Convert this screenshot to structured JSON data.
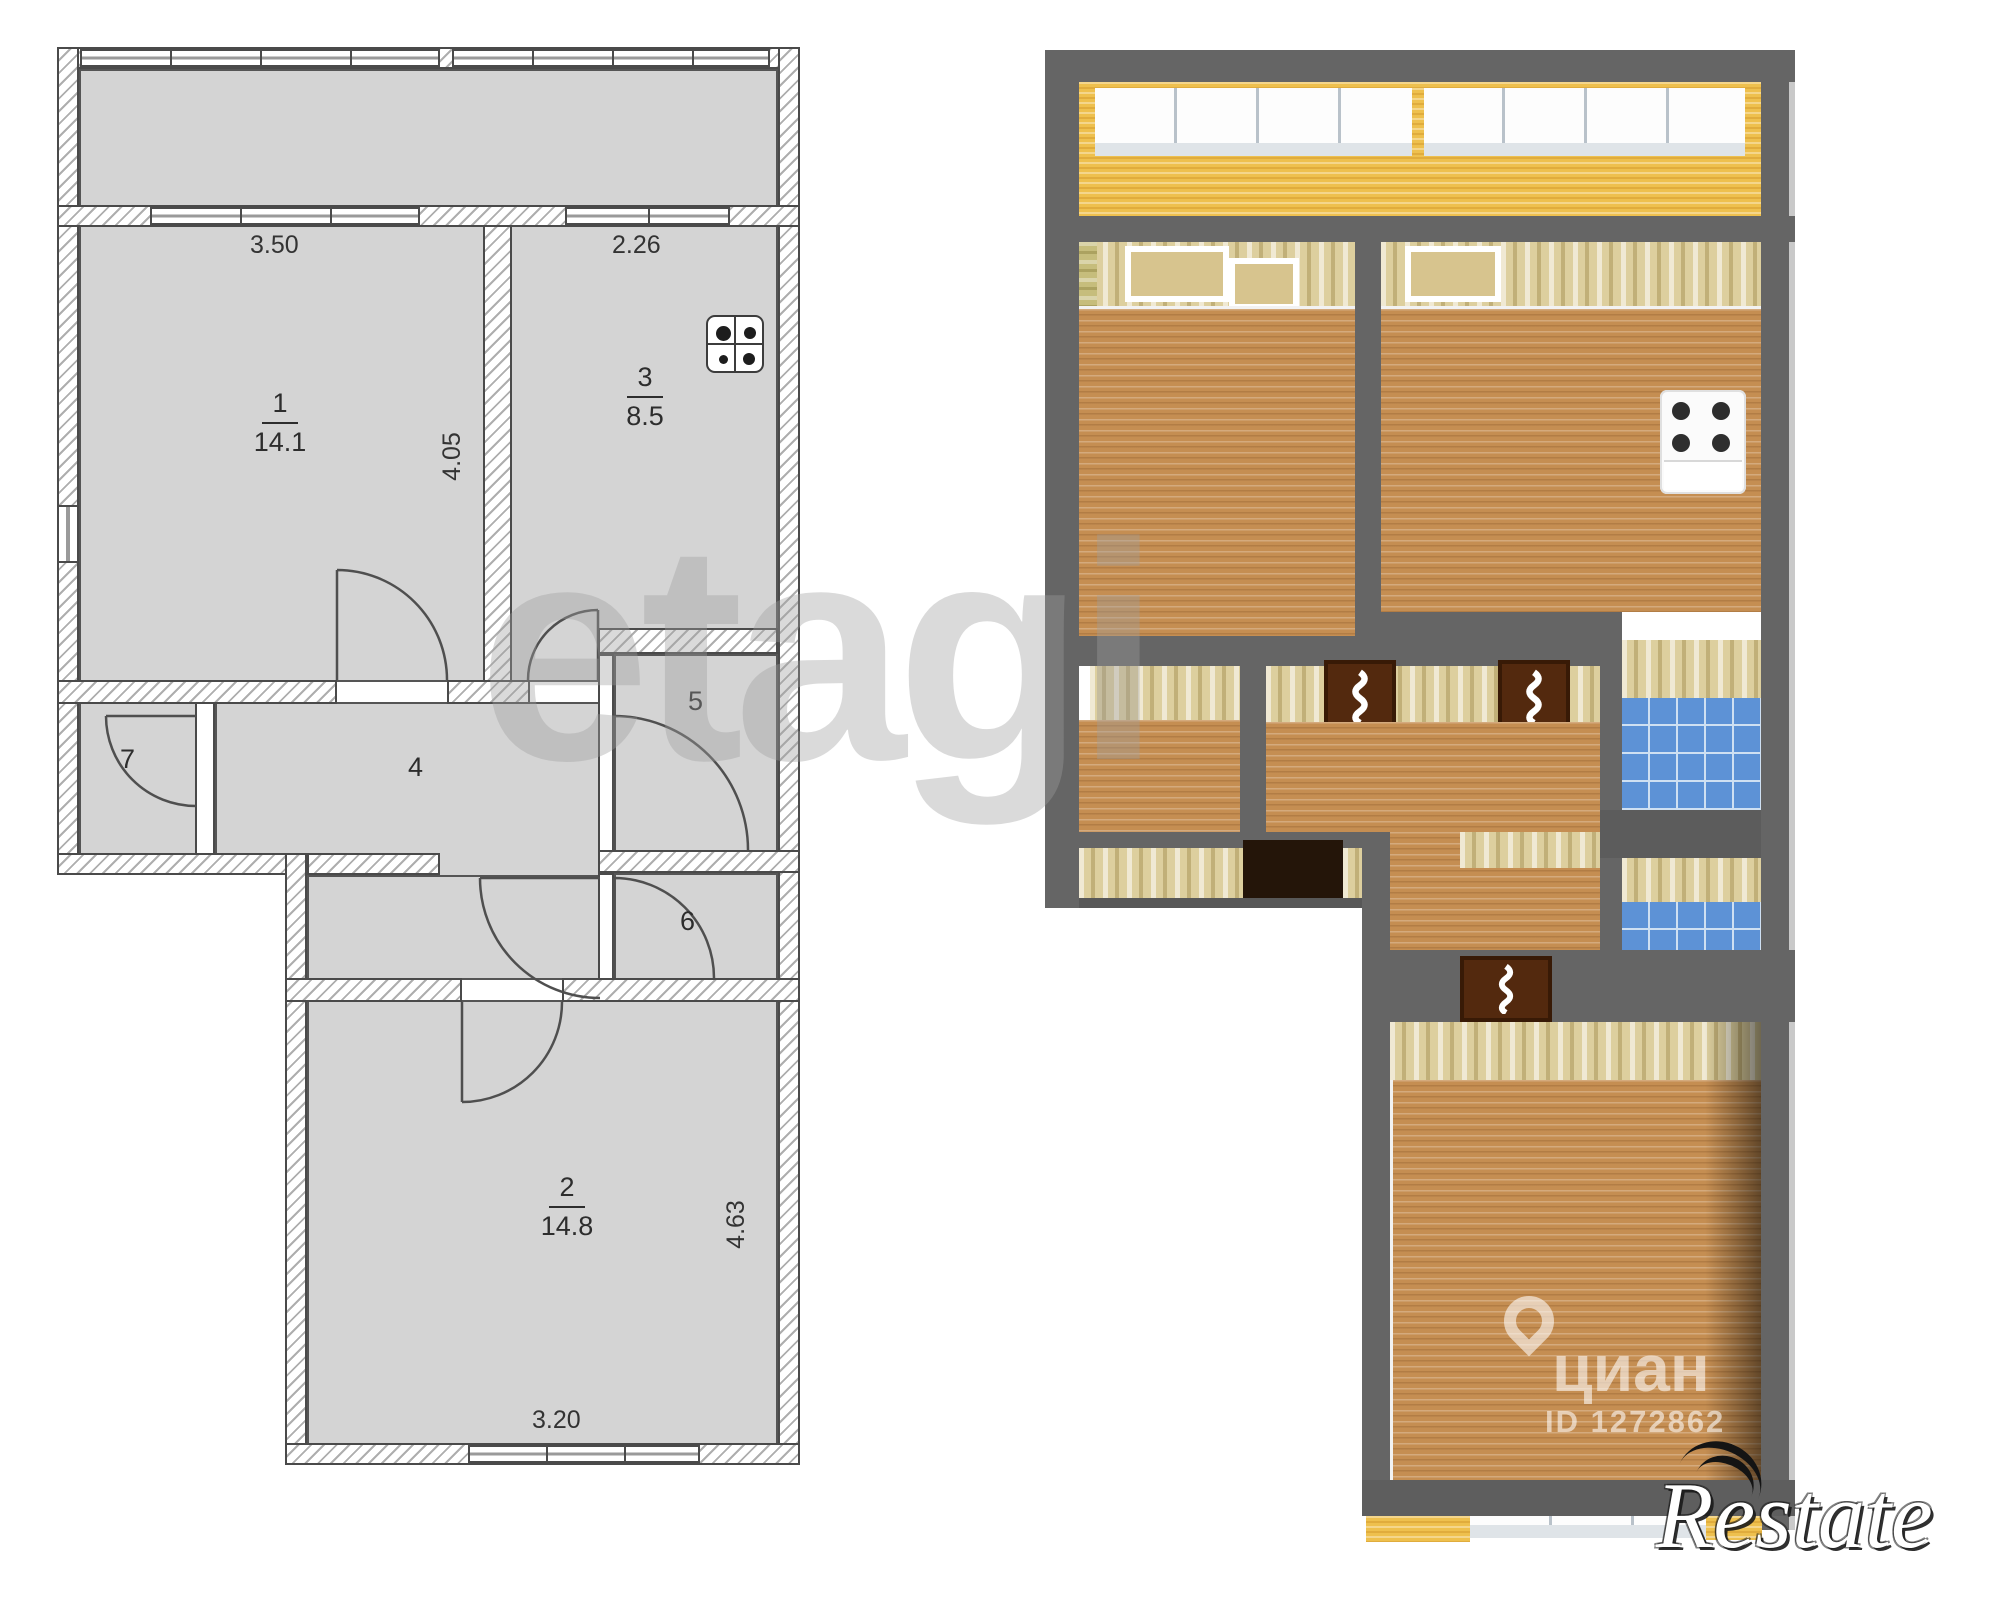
{
  "plan2d": {
    "rooms": [
      {
        "num": "1",
        "area": "14.1"
      },
      {
        "num": "2",
        "area": "14.8"
      },
      {
        "num": "3",
        "area": "8.5"
      },
      {
        "num": "4"
      },
      {
        "num": "5"
      },
      {
        "num": "6"
      },
      {
        "num": "7"
      }
    ],
    "dimensions": {
      "room1_width": "3.50",
      "room1_height": "4.05",
      "room3_width": "2.26",
      "room2_height": "4.63",
      "room2_width": "3.20"
    },
    "icons": {
      "stove": "stove-icon"
    },
    "colors": {
      "room_fill": "#d4d4d4",
      "wall_line": "#4a4a4a"
    }
  },
  "plan3d": {
    "colors": {
      "wall": "#656565",
      "wood_floor": "#c58e52",
      "wallpaper": "#ddcf9e",
      "balcony_floor": "#eec04e",
      "bathroom_tile": "#5d92d6",
      "door": "#53290e"
    },
    "icons": {
      "stove": "stove-icon",
      "door": "open-door-icon"
    }
  },
  "watermarks": {
    "etagi": "etagi",
    "cian": {
      "name": "циан",
      "id": "ID 1272862"
    },
    "restate": "Restate"
  }
}
